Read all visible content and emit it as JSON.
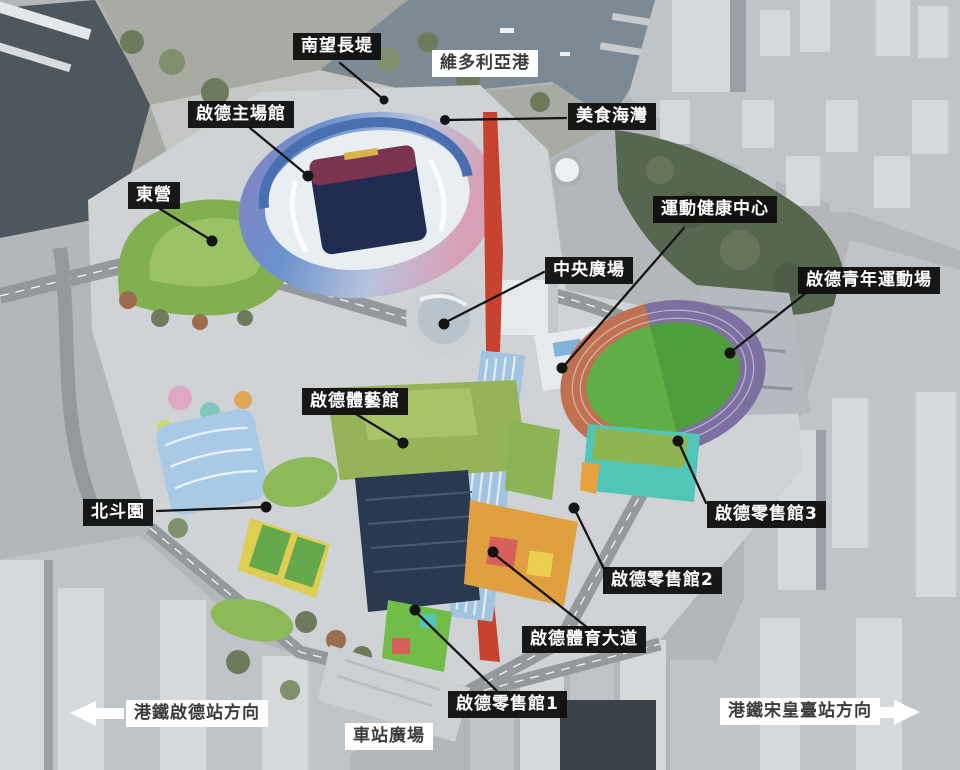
{
  "scene": {
    "description": "Aerial rendering of Kai Tak Sports Park with facility callout labels",
    "labels": {
      "nam_mong_promenade": {
        "text": "南望長堤",
        "style": "dark",
        "pointer": true
      },
      "victoria_harbour": {
        "text": "維多利亞港",
        "style": "light",
        "pointer": false
      },
      "main_stadium": {
        "text": "啟德主場館",
        "style": "dark",
        "pointer": true
      },
      "food_bay": {
        "text": "美食海灣",
        "style": "dark",
        "pointer": true
      },
      "east_camp": {
        "text": "東營",
        "style": "dark",
        "pointer": true
      },
      "health_centre": {
        "text": "運動健康中心",
        "style": "dark",
        "pointer": true
      },
      "central_plaza": {
        "text": "中央廣場",
        "style": "dark",
        "pointer": true
      },
      "youth_sports_ground": {
        "text": "啟德青年運動場",
        "style": "dark",
        "pointer": true
      },
      "arena": {
        "text": "啟德體藝館",
        "style": "dark",
        "pointer": true
      },
      "pak_tau_garden": {
        "text": "北斗園",
        "style": "dark",
        "pointer": true
      },
      "retail_3": {
        "text": "啟德零售館3",
        "style": "dark",
        "pointer": true
      },
      "retail_2": {
        "text": "啟德零售館2",
        "style": "dark",
        "pointer": true
      },
      "sports_avenue": {
        "text": "啟德體育大道",
        "style": "dark",
        "pointer": true
      },
      "retail_1": {
        "text": "啟德零售館1",
        "style": "dark",
        "pointer": true
      },
      "station_square": {
        "text": "車站廣場",
        "style": "light",
        "pointer": false
      },
      "mtr_kai_tak": {
        "text": "港鐵啟德站方向",
        "style": "light",
        "icon": "left-arrow"
      },
      "mtr_sung_wong_toi": {
        "text": "港鐵宋皇臺站方向",
        "style": "light",
        "icon": "right-arrow"
      }
    },
    "icons": {
      "mtr_kai_tak_direction": "left-arrow",
      "mtr_sung_wong_toi_direction": "right-arrow"
    },
    "colors": {
      "label_dark_bg": "#0e0e0e",
      "label_dark_text": "#ffffff",
      "label_light_bg": "#ffffff",
      "label_light_text": "#3c3c3c",
      "pointer_line": "#141414",
      "water": "#4e575e",
      "harbour": "#7d8a93",
      "lawn_green": "#82b050",
      "field_green": "#5fae46",
      "track_red": "#bf7152",
      "track_purple": "#7e6fa2",
      "stadium_shell_purple": "#8b7ec2",
      "stadium_shell_blue": "#6a93cc",
      "stadium_shell_pink": "#d99fb5",
      "stadium_pitch_navy": "#1e2c50",
      "red_walkway": "#c8432f",
      "canopy_blue": "#a3c4e0",
      "retail_teal": "#4fc6b7",
      "retail_orange": "#e0a040",
      "retail_green": "#72bd48",
      "city_grey": "#c6cacd"
    }
  }
}
